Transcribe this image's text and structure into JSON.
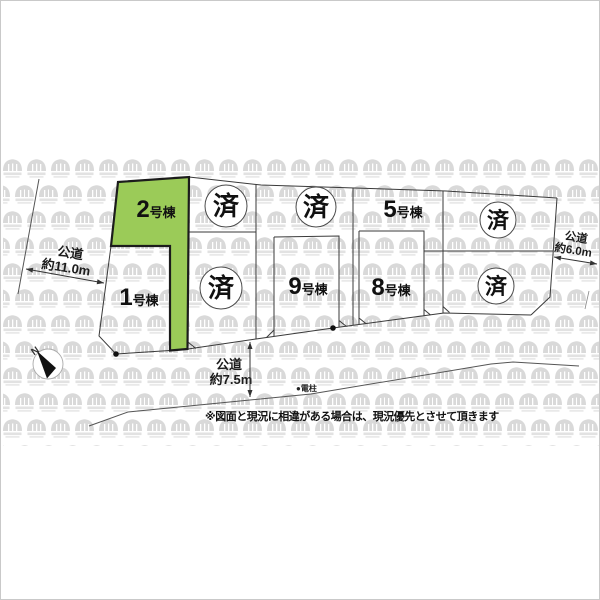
{
  "map": {
    "lots": {
      "lot2": {
        "num": "2",
        "suffix": "号棟"
      },
      "lot1": {
        "num": "1",
        "suffix": "号棟"
      },
      "lot5": {
        "num": "5",
        "suffix": "号棟"
      },
      "lot8": {
        "num": "8",
        "suffix": "号棟"
      },
      "lot9": {
        "num": "9",
        "suffix": "号棟"
      }
    },
    "sold_label": "済",
    "roads": {
      "west": {
        "name": "公道",
        "width": "約11.0m"
      },
      "south": {
        "name": "公道",
        "width": "約7.5m"
      },
      "east": {
        "name": "公道",
        "width": "約6.0m"
      }
    },
    "pole_label": "●電柱",
    "compass": {
      "north": "N"
    },
    "disclaimer": "※図面と現況に相違がある場合は、現況優先とさせて頂きます",
    "colors": {
      "highlight_green": "#9bcb58",
      "line": "#3a3a3a",
      "watermark": "#dcdcdc"
    }
  }
}
